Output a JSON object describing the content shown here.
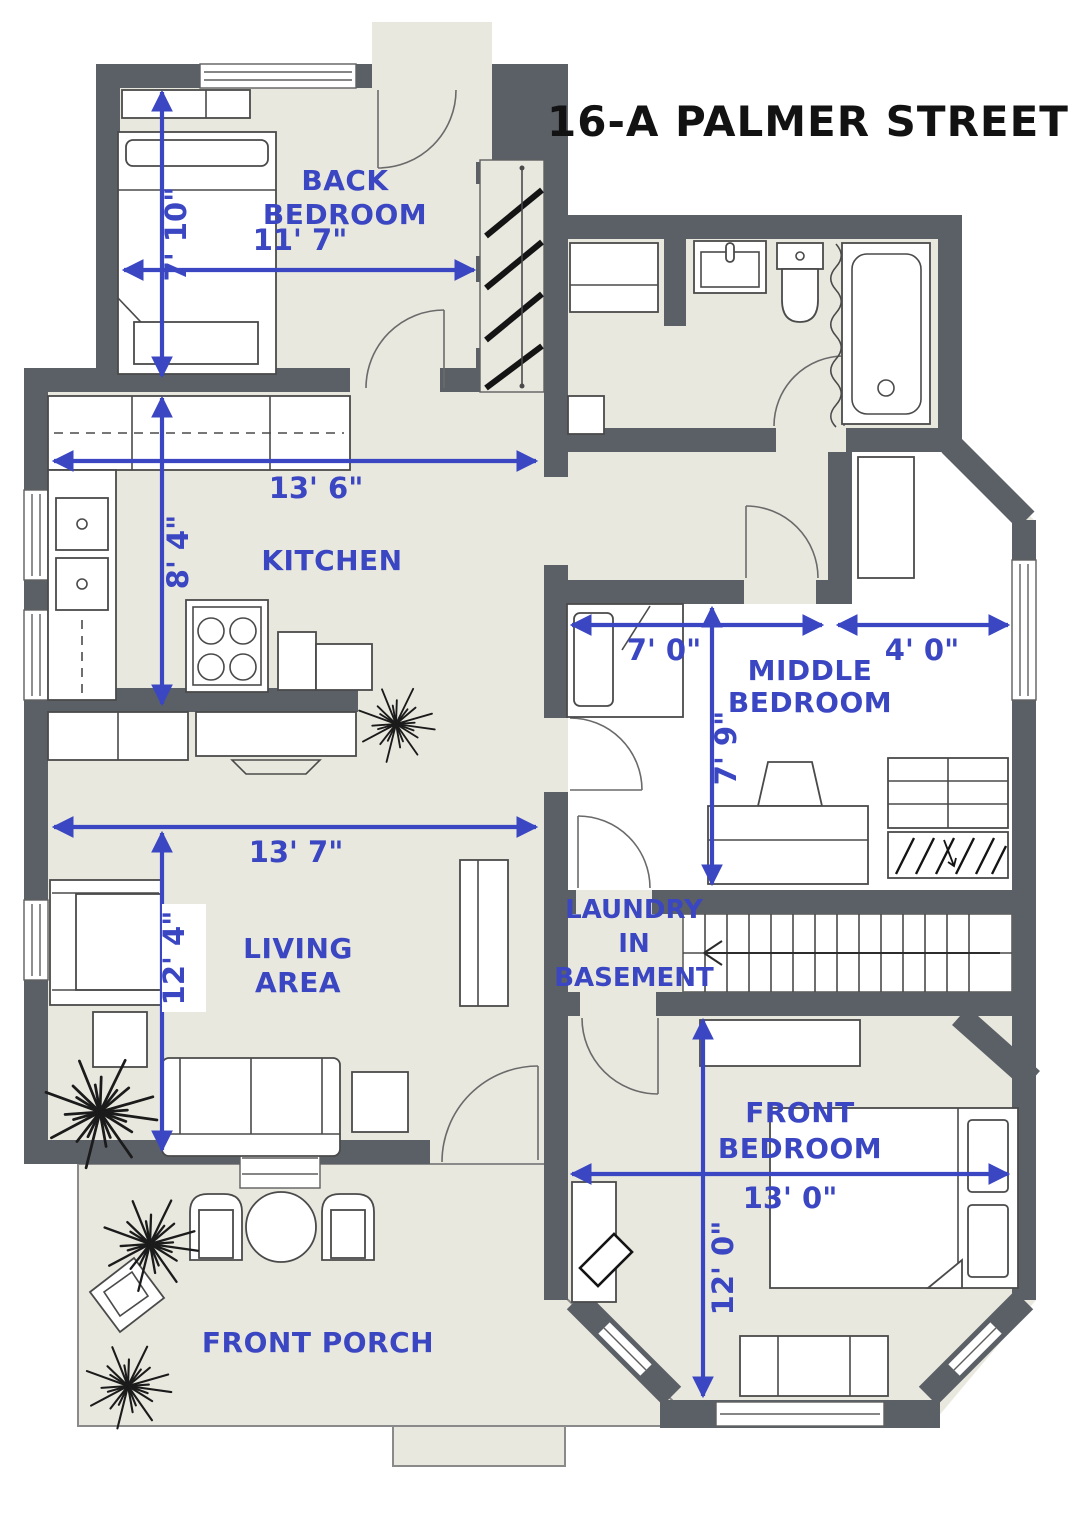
{
  "title": "16-A PALMER STREET",
  "colors": {
    "wall": "#5b6067",
    "floor": "#e9e8df",
    "dimension_blue": "#3a46c2",
    "title_black": "#121212",
    "furniture_outline": "#4a4a4a"
  },
  "rooms": {
    "back_bedroom": {
      "name": "BACK BEDROOM",
      "line1": "BACK",
      "line2": "BEDROOM",
      "width": "11' 7\"",
      "height": "7' 10\""
    },
    "kitchen": {
      "name": "KITCHEN",
      "line1": "KITCHEN",
      "width": "13' 6\"",
      "height": "8' 4\""
    },
    "middle_bedroom": {
      "name": "MIDDLE BEDROOM",
      "line1": "MIDDLE",
      "line2": "BEDROOM",
      "width_left": "7' 0\"",
      "width_right": "4' 0\"",
      "height": "7' 9\""
    },
    "living_area": {
      "name": "LIVING AREA",
      "line1": "LIVING",
      "line2": "AREA",
      "width": "13' 7\"",
      "height": "12' 4\""
    },
    "laundry": {
      "name": "LAUNDRY IN BASEMENT",
      "line1": "LAUNDRY",
      "line2": "IN",
      "line3": "BASEMENT"
    },
    "front_bedroom": {
      "name": "FRONT BEDROOM",
      "line1": "FRONT",
      "line2": "BEDROOM",
      "width": "13' 0\"",
      "height": "12' 0\""
    },
    "front_porch": {
      "name": "FRONT PORCH",
      "line1": "FRONT PORCH"
    }
  }
}
